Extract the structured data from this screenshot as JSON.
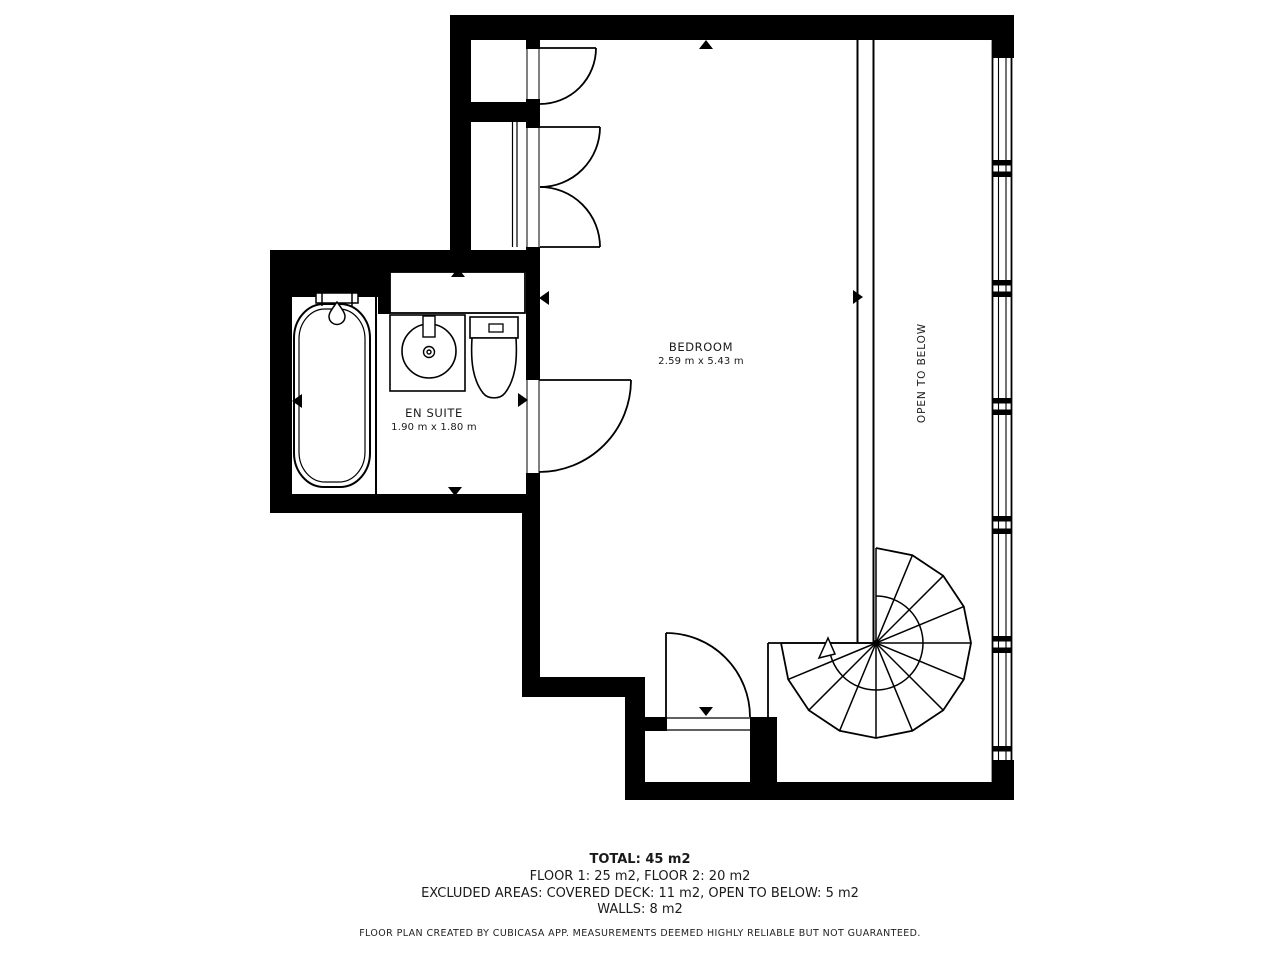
{
  "plan": {
    "rooms": {
      "bedroom": {
        "name": "BEDROOM",
        "dimensions": "2.59 m x 5.43 m"
      },
      "ensuite": {
        "name": "EN SUITE",
        "dimensions": "1.90 m x 1.80 m"
      },
      "open_to_below": {
        "label": "OPEN TO BELOW"
      }
    },
    "summary": {
      "total": "TOTAL: 45 m2",
      "floors": "FLOOR 1: 25 m2, FLOOR 2: 20 m2",
      "excluded_areas": "EXCLUDED AREAS: COVERED DECK: 11 m2, OPEN TO BELOW: 5 m2",
      "walls": "WALLS: 8 m2"
    },
    "disclaimer": "FLOOR PLAN CREATED BY CUBICASA APP. MEASUREMENTS DEEMED HIGHLY RELIABLE BUT NOT GUARANTEED.",
    "colors": {
      "wall": "#000000",
      "background": "#ffffff",
      "text": "#1a1a1a"
    }
  }
}
